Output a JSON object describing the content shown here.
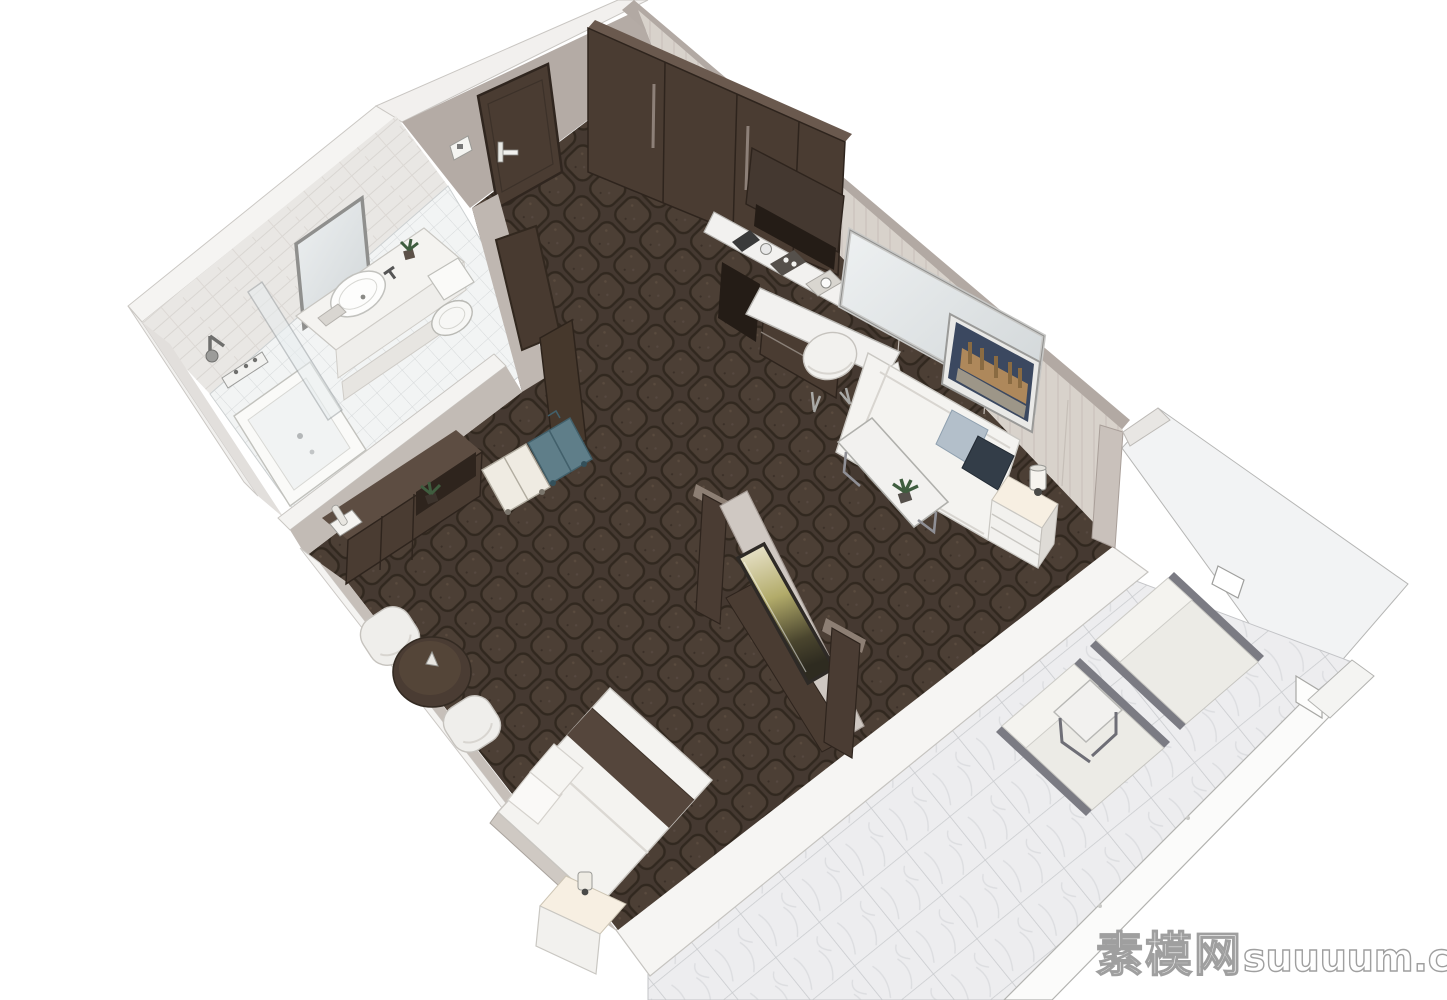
{
  "watermark": {
    "text_cn": "素模网",
    "text_en": "suuuum.com"
  },
  "palette": {
    "bg": "#ffffff",
    "carpet": "#453931",
    "carpet-cell": "#4c3f35",
    "carpet-line": "#31281f",
    "wall": "#b4aba5",
    "wall-lit": "#c2bbb5",
    "wall-paper": "#d8d2cb",
    "wall-top": "#f2f0ee",
    "wall-band": "#b2a9a3",
    "wood": "#4a3c32",
    "wood-dark": "#32281f",
    "wood-top": "#6a594e",
    "marble": "#f2f1ef",
    "white-furn": "#f4f3f0",
    "furn-line": "#c9c7c2",
    "pillow-blue": "#b3bfca",
    "pillow-navy": "#333d48",
    "suitcase-teal": "#5f7e89",
    "suitcase-white": "#efebe2",
    "glass": "#eff1f2",
    "metal": "#9a9a9a",
    "lounger": "#ecebe6",
    "lounger-rail": "#7b7b83",
    "art-sky": "#3b4860",
    "art-city": "#c3945a",
    "plant-green": "#3f5d3f",
    "lamp-warm": "#f7efe2"
  },
  "scene": {
    "title": "hotel-guestroom-3d-floorplan-render",
    "rooms": [
      {
        "name": "bathroom",
        "items": [
          "wall-mirror",
          "vanity-counter",
          "sink",
          "faucet",
          "toilet",
          "bathtub",
          "shower-set",
          "glass-divider",
          "tile-floor",
          "plant"
        ]
      },
      {
        "name": "entry",
        "items": [
          "entry-door",
          "door-handle",
          "light-switch",
          "bathroom-door",
          "white-suitcase",
          "teal-suitcase"
        ]
      },
      {
        "name": "living-area",
        "items": [
          "wardrobe",
          "minibar-cabinet",
          "coffee-station",
          "marble-counter",
          "wall-mirror",
          "writing-desk",
          "desk-chair",
          "cityscape-artwork",
          "sofa",
          "blue-pillow",
          "navy-pillow",
          "side-cabinet",
          "table-lamp",
          "coffee-table",
          "plant",
          "tv-partition",
          "tv-screen"
        ]
      },
      {
        "name": "sleeping-area",
        "items": [
          "dresser",
          "telephone",
          "plant",
          "tub-chair",
          "tub-chair",
          "round-side-table",
          "bed",
          "bed-runner",
          "pillows",
          "nightstand",
          "bedside-lamp"
        ]
      },
      {
        "name": "balcony",
        "items": [
          "marble-tile-floor",
          "glass-balustrade",
          "white-railing",
          "sun-lounger",
          "sun-lounger",
          "side-table",
          "wall-light"
        ]
      }
    ]
  }
}
